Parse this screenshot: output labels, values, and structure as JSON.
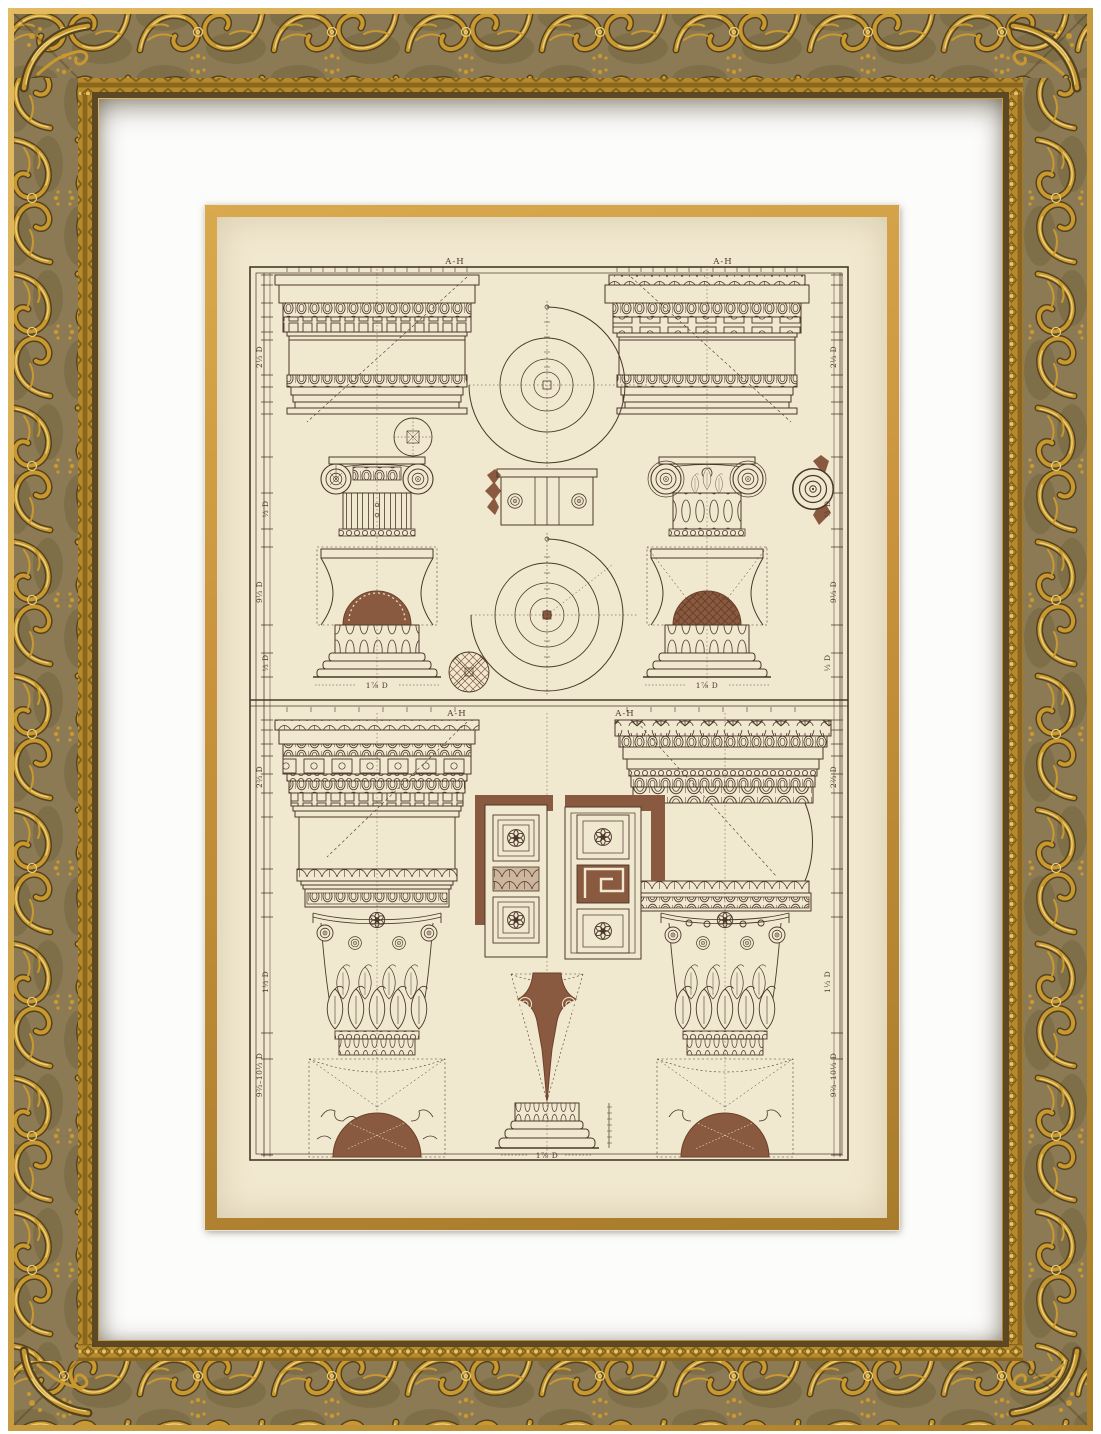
{
  "colors": {
    "frame-bg": "#8c7a54",
    "frame-bg-dark": "#75653f",
    "frame-gold": "#c9992f",
    "frame-gold-light": "#ecd07c",
    "frame-gold-dark": "#54421f",
    "bead-bg": "#b6892c",
    "bead-light": "#e7c366",
    "mat": "#fcfcfb",
    "print-border": "#c5913c",
    "paper": "#f1e8d0",
    "ink": "#4a382a",
    "ink-light": "#7a6450",
    "fill-brown": "#8a5a40",
    "fill-brown-dark": "#6d4129"
  },
  "plate": {
    "section_top": {
      "label_left": "A-H",
      "label_right": "A-H",
      "dims_left": [
        "2⅓ D",
        "⅓ D",
        "9⅓ D",
        "⅓ D"
      ],
      "dims_right": [
        "2⅓ D",
        "⅓ D",
        "9⅓ D",
        "⅓ D"
      ],
      "base_label_left": "1⅞ D",
      "base_label_right": "1⅞ D"
    },
    "section_bottom": {
      "label_left": "A-H",
      "label_right": "A-H",
      "dims_left": [
        "2⅔ D",
        "1⅓ D",
        "9⅔–10⅓ D"
      ],
      "dims_right": [
        "2⅔ D",
        "1⅓ D",
        "9⅔–10⅓ D"
      ],
      "base_label_center": "1⅞ D"
    }
  }
}
